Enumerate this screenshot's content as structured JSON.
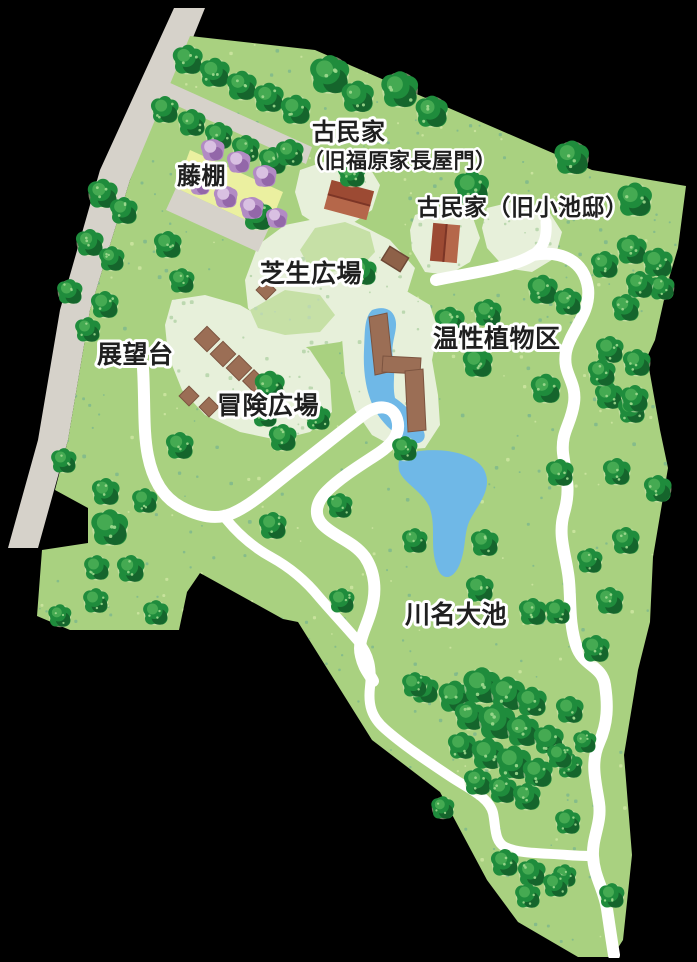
{
  "map": {
    "name": "park-guide-map",
    "background_color": "#000000",
    "colors": {
      "road": "#d6d2ca",
      "park_green": "#a9d180",
      "speckle_dark": "#7fb98c",
      "speckle_light": "#cbe49f",
      "lawn": "#e7f0da",
      "lawn_speckle": "#bcd8b0",
      "mid_green": "#c6e0a6",
      "tree_dark": "#14602a",
      "tree_main": "#1f8c3c",
      "tree_light": "#45aa52",
      "tree_halo": "#d4e8b4",
      "tree_dot": "#9fd98f",
      "water": "#6fb8e7",
      "path": "#ffffff",
      "wisteria_area": "#ebf0a0",
      "bush_main": "#b28bc4",
      "bush_dark": "#8f63a6",
      "bush_light": "#d9c0e2",
      "building_dark": "#9c4a33",
      "building_light": "#b5674a",
      "building_ridge": "#7c3526",
      "wood": "#9b6e55",
      "wood_edge": "#7c5440",
      "label_fill": "#1f1f1f",
      "label_stroke": "#ffffff"
    },
    "labels": [
      {
        "id": "kominka-line1",
        "text": "古民家",
        "x": 312,
        "y": 140,
        "size": 24
      },
      {
        "id": "kominka-line2",
        "text": "（旧福原家長屋門）",
        "x": 303,
        "y": 168,
        "size": 21
      },
      {
        "id": "kominka-koike",
        "text": "古民家（旧小池邸）",
        "x": 417,
        "y": 215,
        "size": 23
      },
      {
        "id": "fujidana",
        "text": "藤棚",
        "x": 177,
        "y": 184,
        "size": 24
      },
      {
        "id": "shibafu",
        "text": "芝生広場",
        "x": 260,
        "y": 282,
        "size": 25
      },
      {
        "id": "tenbodai",
        "text": "展望台",
        "x": 97,
        "y": 363,
        "size": 25
      },
      {
        "id": "boken",
        "text": "冒険広場",
        "x": 217,
        "y": 414,
        "size": 25
      },
      {
        "id": "onsei",
        "text": "温性植物区",
        "x": 433,
        "y": 347,
        "size": 25
      },
      {
        "id": "kawana-oike",
        "text": "川名大池",
        "x": 405,
        "y": 623,
        "size": 25
      }
    ],
    "features": {
      "trees": [
        [
          188,
          60,
          13
        ],
        [
          215,
          73,
          13
        ],
        [
          242,
          86,
          13
        ],
        [
          269,
          98,
          13
        ],
        [
          296,
          110,
          13
        ],
        [
          330,
          75,
          17
        ],
        [
          358,
          97,
          14
        ],
        [
          400,
          90,
          16
        ],
        [
          432,
          112,
          14
        ],
        [
          165,
          110,
          12
        ],
        [
          192,
          123,
          12
        ],
        [
          219,
          136,
          12
        ],
        [
          246,
          149,
          12
        ],
        [
          273,
          161,
          12
        ],
        [
          103,
          194,
          13
        ],
        [
          124,
          211,
          12
        ],
        [
          90,
          243,
          12
        ],
        [
          112,
          259,
          11
        ],
        [
          70,
          292,
          11
        ],
        [
          105,
          305,
          12
        ],
        [
          88,
          330,
          11
        ],
        [
          168,
          245,
          12
        ],
        [
          258,
          216,
          13
        ],
        [
          290,
          153,
          12
        ],
        [
          352,
          174,
          12
        ],
        [
          363,
          272,
          12
        ],
        [
          182,
          281,
          11
        ],
        [
          472,
          188,
          15
        ],
        [
          572,
          158,
          15
        ],
        [
          635,
          200,
          15
        ],
        [
          632,
          250,
          13
        ],
        [
          658,
          263,
          13
        ],
        [
          662,
          288,
          11
        ],
        [
          640,
          285,
          12
        ],
        [
          605,
          265,
          12
        ],
        [
          543,
          290,
          13
        ],
        [
          568,
          302,
          12
        ],
        [
          626,
          308,
          12
        ],
        [
          610,
          350,
          12
        ],
        [
          637,
          363,
          12
        ],
        [
          609,
          396,
          12
        ],
        [
          632,
          410,
          12
        ],
        [
          450,
          322,
          13
        ],
        [
          488,
          313,
          12
        ],
        [
          478,
          363,
          13
        ],
        [
          546,
          389,
          13
        ],
        [
          602,
          373,
          12
        ],
        [
          635,
          399,
          12
        ],
        [
          270,
          386,
          13
        ],
        [
          180,
          446,
          12
        ],
        [
          283,
          438,
          12
        ],
        [
          265,
          415,
          11
        ],
        [
          318,
          418,
          11
        ],
        [
          560,
          473,
          12
        ],
        [
          617,
          472,
          12
        ],
        [
          658,
          489,
          12
        ],
        [
          626,
          541,
          12
        ],
        [
          590,
          561,
          11
        ],
        [
          610,
          601,
          12
        ],
        [
          558,
          612,
          11
        ],
        [
          596,
          649,
          12
        ],
        [
          570,
          710,
          12
        ],
        [
          570,
          766,
          11
        ],
        [
          568,
          822,
          11
        ],
        [
          565,
          876,
          10
        ],
        [
          612,
          896,
          11
        ],
        [
          405,
          449,
          11
        ],
        [
          340,
          506,
          11
        ],
        [
          485,
          543,
          12
        ],
        [
          480,
          589,
          12
        ],
        [
          533,
          612,
          12
        ],
        [
          273,
          526,
          12
        ],
        [
          415,
          541,
          11
        ],
        [
          342,
          601,
          11
        ],
        [
          64,
          461,
          11
        ],
        [
          106,
          492,
          12
        ],
        [
          145,
          501,
          11
        ],
        [
          110,
          528,
          16
        ],
        [
          97,
          568,
          11
        ],
        [
          131,
          569,
          12
        ],
        [
          96,
          601,
          11
        ],
        [
          60,
          616,
          10
        ],
        [
          156,
          613,
          11
        ],
        [
          425,
          690,
          12
        ],
        [
          455,
          697,
          14
        ],
        [
          482,
          686,
          16
        ],
        [
          508,
          694,
          15
        ],
        [
          532,
          702,
          13
        ],
        [
          470,
          716,
          13
        ],
        [
          497,
          722,
          16
        ],
        [
          523,
          731,
          14
        ],
        [
          549,
          740,
          13
        ],
        [
          462,
          746,
          12
        ],
        [
          488,
          754,
          14
        ],
        [
          514,
          763,
          15
        ],
        [
          538,
          773,
          13
        ],
        [
          478,
          782,
          12
        ],
        [
          503,
          790,
          12
        ],
        [
          527,
          797,
          12
        ],
        [
          560,
          756,
          11
        ],
        [
          585,
          742,
          10
        ],
        [
          415,
          685,
          11
        ],
        [
          505,
          863,
          12
        ],
        [
          532,
          873,
          12
        ],
        [
          556,
          885,
          11
        ],
        [
          528,
          896,
          11
        ],
        [
          443,
          808,
          10
        ]
      ],
      "wisteria_bushes": [
        [
          213,
          150,
          11
        ],
        [
          239,
          162,
          11
        ],
        [
          265,
          176,
          11
        ],
        [
          200,
          185,
          10
        ],
        [
          226,
          197,
          11
        ],
        [
          252,
          208,
          11
        ],
        [
          277,
          218,
          10
        ]
      ],
      "adventure_blocks": [
        [
          207,
          339,
          9
        ],
        [
          223,
          354,
          9
        ],
        [
          239,
          368,
          9
        ],
        [
          254,
          381,
          8
        ],
        [
          189,
          396,
          7
        ],
        [
          209,
          407,
          7
        ],
        [
          266,
          290,
          7
        ]
      ],
      "buildings": [
        {
          "id": "nagayamon",
          "cx": 349,
          "cy": 200,
          "w": 44,
          "h": 30,
          "rot": 15,
          "split": "h"
        },
        {
          "id": "koike-tei",
          "cx": 445,
          "cy": 243,
          "w": 27,
          "h": 38,
          "rot": 5,
          "split": "v"
        },
        {
          "id": "small-shed",
          "cx": 395,
          "cy": 259,
          "w": 22,
          "h": 16,
          "rot": 32,
          "split": "none"
        }
      ]
    }
  }
}
